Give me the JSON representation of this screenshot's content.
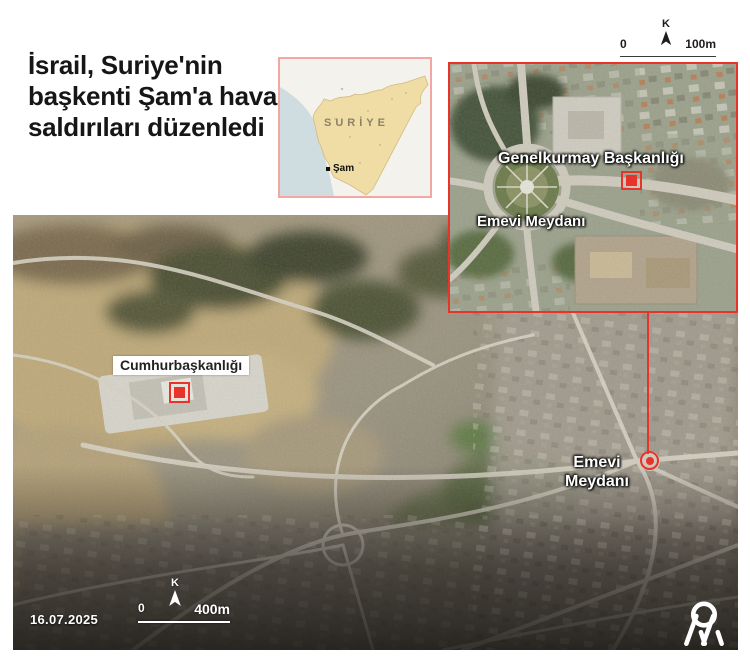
{
  "headline": "İsrail, Suriye'nin başkenti Şam'a hava saldırıları düzenledi",
  "syria_map": {
    "country": "SURİYE",
    "capital": "Şam"
  },
  "inset": {
    "hq_label": "Genelkurmay Başkanlığı",
    "square_label": "Emevi Meydanı",
    "scale": {
      "north": "K",
      "start": "0",
      "end": "100m"
    }
  },
  "main_map": {
    "palace_label": "Cumhurbaşkanlığı",
    "square_label_line1": "Emevi",
    "square_label_line2": "Meydanı",
    "date": "16.07.2025",
    "scale": {
      "north": "K",
      "start": "0",
      "end": "400m"
    }
  },
  "branding": {
    "agency_monogram": "AA"
  },
  "colors": {
    "accent_red": "#e8332b",
    "syria_border_pink": "#f2a7a3",
    "syria_land": "#f0dda5",
    "syria_sea": "#cfdce0"
  }
}
